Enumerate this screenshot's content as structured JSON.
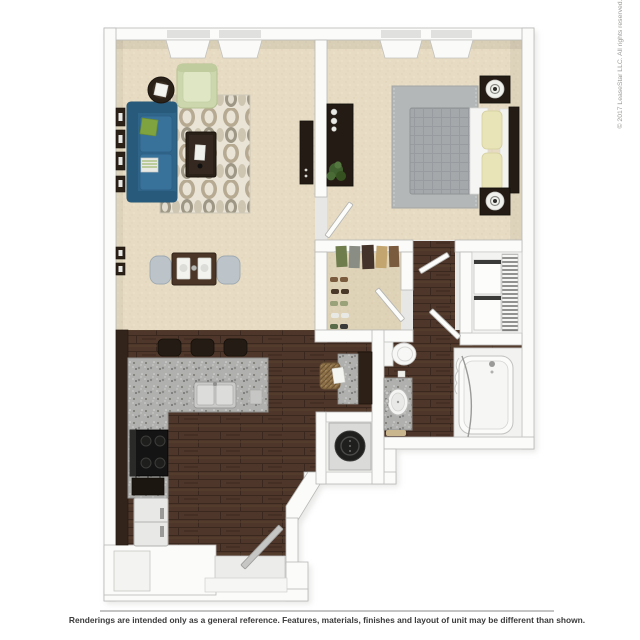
{
  "caption": "3D top-down floor plan rendering of a one-bedroom, one-bath apartment",
  "footer": {
    "disclaimer": "Renderings are intended only as a general reference. Features, materials, finishes and layout of unit may be different than shown."
  },
  "watermark": {
    "copyright": "© 2017 LeaseStar LLC. All rights reserved."
  },
  "palette": {
    "background": "#ffffff",
    "wall": "#fbfbfa",
    "wall_outline": "#b9b9b7",
    "carpet": "#e7dcc3",
    "hardwood": "#4e362a",
    "granite": "#b0b0ae",
    "sofa_teal": "#2f6589",
    "armchair_sage": "#cdd7ae",
    "pillow_green": "#7fa33e",
    "bed_duvet_gray": "#a4a8ab",
    "pillow_yellow": "#e9e4b8",
    "furniture_dark_wood": "#241c14",
    "living_rug_base": "#eae4d7",
    "living_rug_pattern": "#b7aa92",
    "bedroom_rug_gray": "#b4b7b7",
    "dining_chair_gray_blue": "#bcc4ca",
    "appliance_white": "#e8e8e6",
    "washer_drum_black": "#1f1f1d",
    "basket_weave_tan": "#8d7148",
    "plant_green": "#41602f",
    "bath_fixture_white": "#f4f4f2",
    "footer_text": "#3b3b3b",
    "watermark_text": "#9a9a98"
  },
  "rooms": {
    "living_room": [
      "sofa",
      "armchair",
      "side table with lamp",
      "coffee table",
      "patterned area rug",
      "media console",
      "wall art",
      "two windows"
    ],
    "dining_area": [
      "dining table with two place settings",
      "two chairs",
      "wall art"
    ],
    "bedroom": [
      "bed with gray duvet and yellow pillows",
      "headboard",
      "two nightstands with lamps",
      "dresser with plant",
      "gray rug",
      "two windows"
    ],
    "walk_in_closet": [
      "hanging clothes",
      "shoes"
    ],
    "hallway": [
      "door swings"
    ],
    "linen_closet": [
      "wire shelving",
      "storage bins"
    ],
    "bathroom": [
      "toilet",
      "granite vanity with round sink",
      "bathtub with curtain"
    ],
    "laundry_closet": [
      "washer/dryer unit"
    ],
    "kitchen": [
      "granite peninsula with double sink",
      "three bar stools",
      "stove",
      "refrigerator",
      "dark cabinetry",
      "desk nook with woven chair"
    ],
    "entry": [
      "open entry door",
      "step",
      "entry closet"
    ]
  }
}
